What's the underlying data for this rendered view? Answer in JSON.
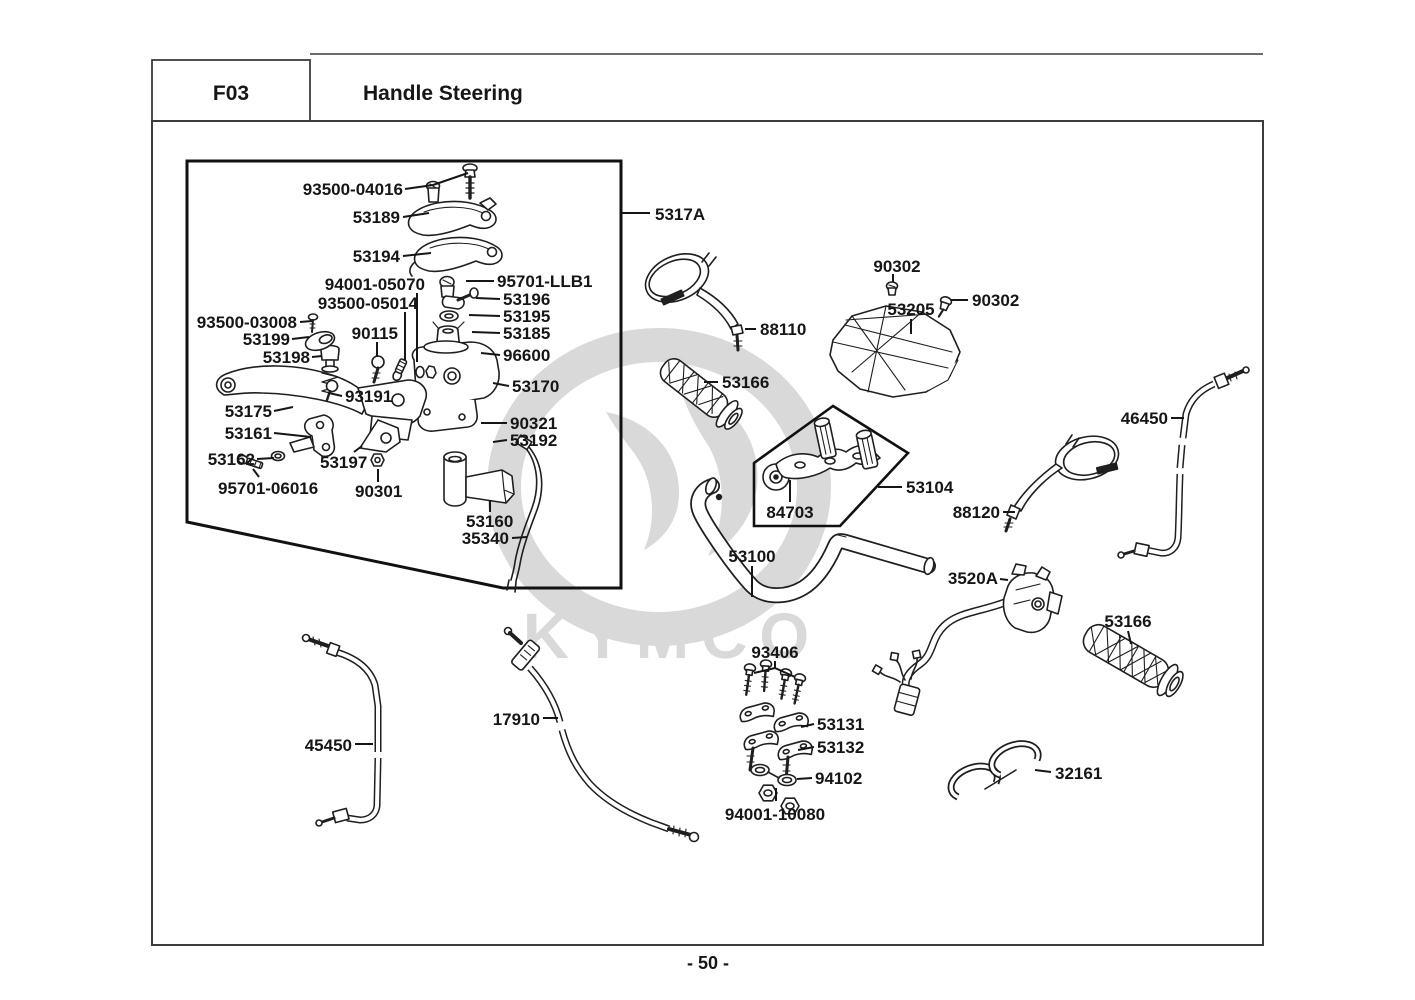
{
  "header": {
    "code": "F03",
    "title": "Handle Steering"
  },
  "footer": {
    "page_number": "- 50 -"
  },
  "watermark": {
    "brand": "KYMCO"
  },
  "colors": {
    "ink": "#1f1f1f",
    "frame": "#3c3c3c",
    "watermark": "#d9d9d9",
    "background": "#ffffff"
  },
  "labels": {
    "n93500_04016": "93500-04016",
    "n53189": "53189",
    "n53194": "53194",
    "n94001_05070": "94001-05070",
    "n93500_05014": "93500-05014",
    "n95701_llb1": "95701-LLB1",
    "n53196": "53196",
    "n53195": "53195",
    "n53185": "53185",
    "n96600": "96600",
    "n93500_03008": "93500-03008",
    "n53199": "53199",
    "n90115": "90115",
    "n53198": "53198",
    "n53170": "53170",
    "n93191": "93191",
    "n53175": "53175",
    "n53161": "53161",
    "n90321": "90321",
    "n53192": "53192",
    "n53162": "53162",
    "n53197": "53197",
    "n95701_06016": "95701-06016",
    "n90301": "90301",
    "n53160": "53160",
    "n35340": "35340",
    "n5317a": "5317A",
    "n88110": "88110",
    "n90302_top": "90302",
    "n53205": "53205",
    "n90302_side": "90302",
    "n53166_left": "53166",
    "n46450": "46450",
    "n53104": "53104",
    "n84703": "84703",
    "n88120": "88120",
    "n53100": "53100",
    "n3520a": "3520A",
    "n53166_right": "53166",
    "n93406": "93406",
    "n17910": "17910",
    "n45450": "45450",
    "n53131": "53131",
    "n53132": "53132",
    "n94102": "94102",
    "n94001_10080": "94001-10080",
    "n32161": "32161"
  }
}
